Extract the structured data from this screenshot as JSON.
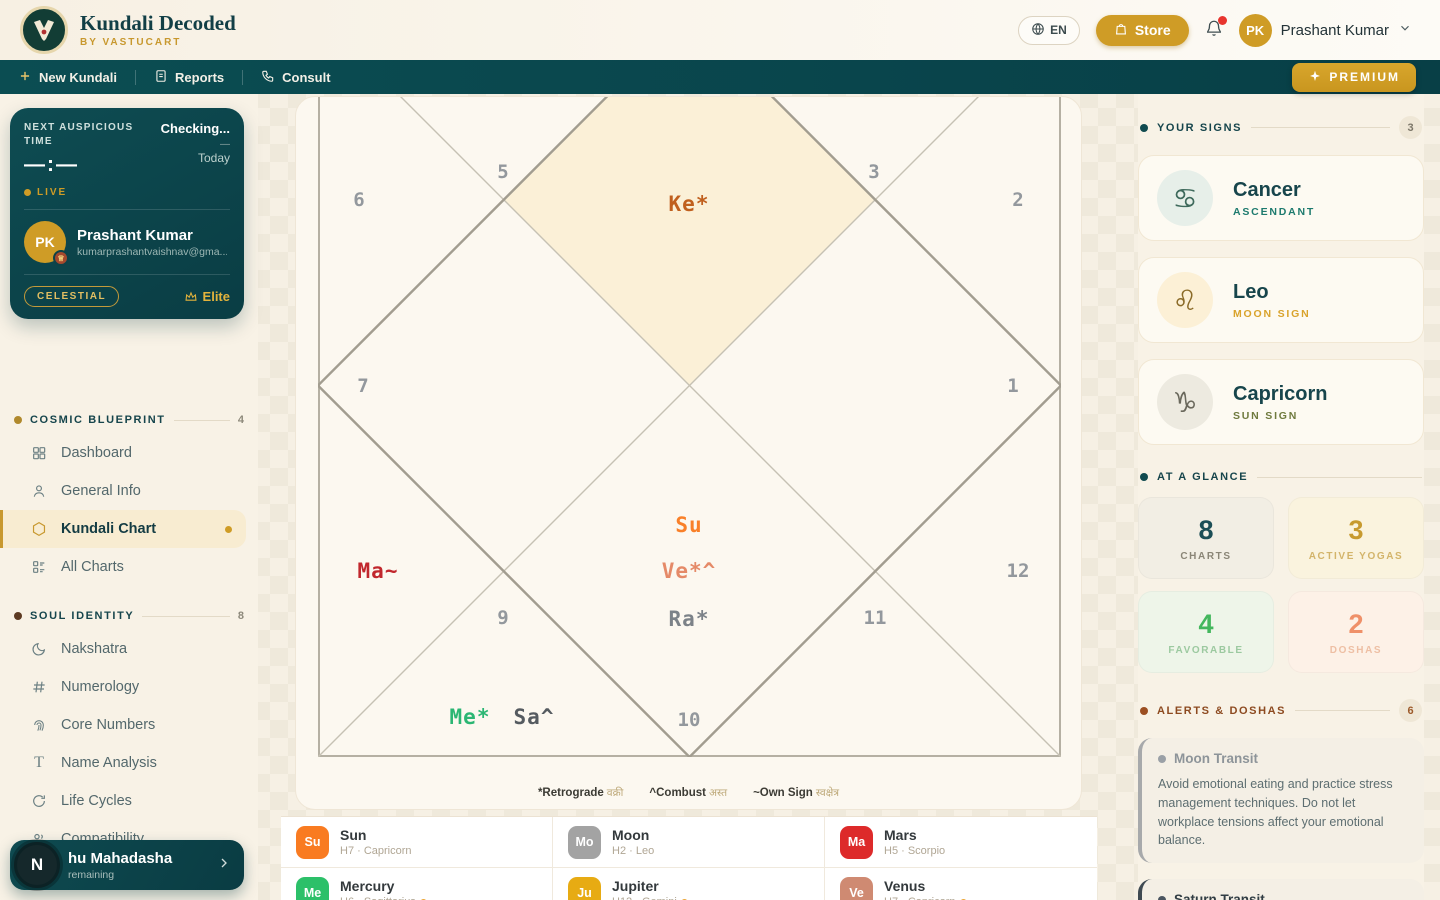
{
  "header": {
    "app_title": "Kundali Decoded",
    "app_subtitle": "BY VASTUCART",
    "language_label": "EN",
    "store_label": "Store",
    "user": {
      "initials": "PK",
      "name": "Prashant Kumar"
    }
  },
  "navbar": {
    "new_kundali": "New Kundali",
    "reports": "Reports",
    "consult": "Consult",
    "premium_label": "PREMIUM"
  },
  "sidebar": {
    "auspicious": {
      "label": "NEXT AUSPICIOUS TIME",
      "status": "Checking...",
      "dash": "—",
      "day": "Today",
      "time": "—:—",
      "live": "LIVE"
    },
    "profile": {
      "initials": "PK",
      "name": "Prashant Kumar",
      "email": "kumarprashantvaishnav@gma...",
      "tier": "CELESTIAL",
      "plan": "Elite"
    },
    "sections": [
      {
        "title": "COSMIC BLUEPRINT",
        "count": "4",
        "dot_color": "#b0892c",
        "items": [
          {
            "label": "Dashboard"
          },
          {
            "label": "General Info"
          },
          {
            "label": "Kundali Chart"
          },
          {
            "label": "All Charts"
          }
        ]
      },
      {
        "title": "SOUL IDENTITY",
        "count": "8",
        "dot_color": "#5d3a22",
        "items": [
          {
            "label": "Nakshatra"
          },
          {
            "label": "Numerology"
          },
          {
            "label": "Core Numbers"
          },
          {
            "label": "Name Analysis"
          },
          {
            "label": "Life Cycles"
          },
          {
            "label": "Compatibility"
          },
          {
            "label": "Lucky Elements"
          }
        ]
      }
    ],
    "mahadasha": {
      "initial": "N",
      "title": "hu Mahadasha",
      "subtitle": "remaining"
    }
  },
  "kundali_chart": {
    "houses": [
      {
        "n": "5"
      },
      {
        "n": "3"
      },
      {
        "n": "6"
      },
      {
        "n": "2"
      },
      {
        "n": "7"
      },
      {
        "n": "1"
      },
      {
        "n": "9"
      },
      {
        "n": "11"
      },
      {
        "n": "12"
      },
      {
        "n": "10"
      }
    ],
    "planets": [
      {
        "label": "Ke*",
        "color": "#c05f1d"
      },
      {
        "label": "Su",
        "color": "#f98029"
      },
      {
        "label": "Ve*^",
        "color": "#e58a68"
      },
      {
        "label": "Ra*",
        "color": "#7c8288"
      },
      {
        "label": "Ma~",
        "color": "#c1272d"
      },
      {
        "label": "Me*",
        "color": "#2bb673"
      },
      {
        "label": "Sa^",
        "color": "#555b60"
      }
    ],
    "highlight_color": "#fbf0d7",
    "legend": [
      {
        "symbol": "*",
        "label": "Retrograde",
        "hindi": "वक्री"
      },
      {
        "symbol": "^",
        "label": "Combust",
        "hindi": "अस्त"
      },
      {
        "symbol": "~",
        "label": "Own Sign",
        "hindi": "स्वक्षेत्र"
      }
    ]
  },
  "planet_list": [
    {
      "abbr": "Su",
      "name": "Sun",
      "detail": "H7 · Capricorn",
      "color": "#f97b21"
    },
    {
      "abbr": "Mo",
      "name": "Moon",
      "detail": "H2 · Leo",
      "color": "#a3a3a3"
    },
    {
      "abbr": "Ma",
      "name": "Mars",
      "detail": "H5 · Scorpio",
      "color": "#dd2a2a"
    },
    {
      "abbr": "Me",
      "name": "Mercury",
      "detail": "H6 · Sagittarius",
      "color": "#2cc069"
    },
    {
      "abbr": "Ju",
      "name": "Jupiter",
      "detail": "H12 · Gemini",
      "color": "#e7ab13"
    },
    {
      "abbr": "Ve",
      "name": "Venus",
      "detail": "H7 · Capricorn",
      "color": "#cf8a72"
    }
  ],
  "right": {
    "your_signs": {
      "title": "YOUR SIGNS",
      "count": "3",
      "cards": [
        {
          "sign": "Cancer",
          "role": "ASCENDANT",
          "glyph": "♋",
          "role_color": "#1d7a6e",
          "icon_bg": "#e7efe9",
          "icon_color": "#3f6a5c"
        },
        {
          "sign": "Leo",
          "role": "MOON SIGN",
          "glyph": "♌",
          "role_color": "#d9a32c",
          "icon_bg": "#fcf0d6",
          "icon_color": "#8a6a27"
        },
        {
          "sign": "Capricorn",
          "role": "SUN SIGN",
          "glyph": "♑",
          "role_color": "#6f7a3e",
          "icon_bg": "#edeae0",
          "icon_color": "#6a685c"
        }
      ]
    },
    "at_a_glance": {
      "title": "AT A GLANCE",
      "stats": [
        {
          "value": "8",
          "label": "CHARTS",
          "color": "#1c4e56",
          "bg": "#f2eee4"
        },
        {
          "value": "3",
          "label": "ACTIVE YOGAS",
          "color": "#c79a2f",
          "bg": "#faf3de"
        },
        {
          "value": "4",
          "label": "FAVORABLE",
          "color": "#43b75d",
          "bg": "#eef5e9"
        },
        {
          "value": "2",
          "label": "DOSHAS",
          "color": "#ef9069",
          "bg": "#fdf1e7"
        }
      ]
    },
    "alerts": {
      "title": "ALERTS & DOSHAS",
      "count": "6",
      "cards": [
        {
          "title": "Moon Transit",
          "body": "Avoid emotional eating and practice stress management techniques. Do not let workplace tensions affect your emotional balance.",
          "accent": "#a7a9ab",
          "title_color": "#8d9499"
        },
        {
          "title": "Saturn Transit",
          "body": "",
          "accent": "#3f4a52",
          "title_color": "#313d44"
        }
      ]
    }
  }
}
